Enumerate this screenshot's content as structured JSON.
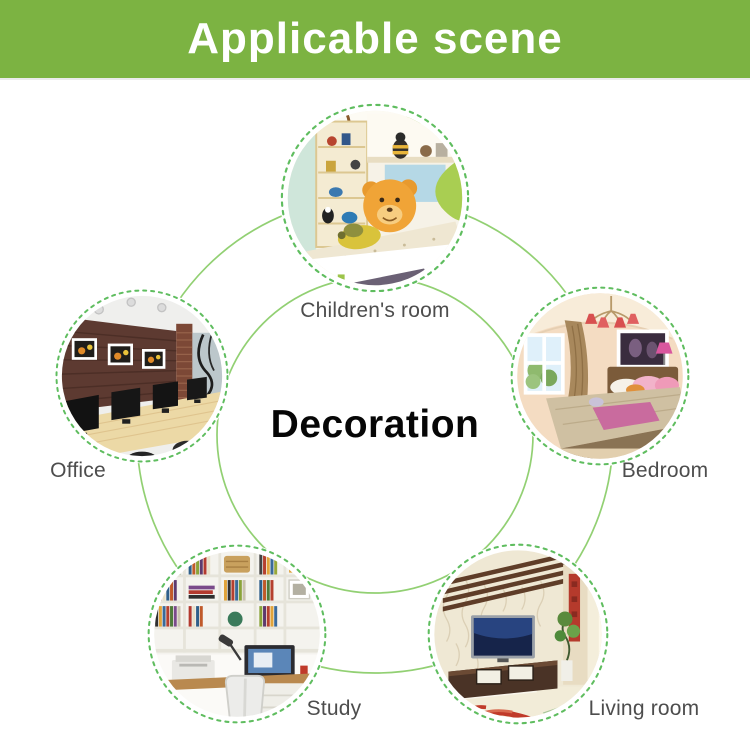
{
  "banner": {
    "title": "Applicable scene",
    "background_color": "#7cb342",
    "text_color": "#ffffff"
  },
  "diagram": {
    "center_title": "Decoration",
    "connector_color": "#92d073",
    "dashed_ring_color": "#5fbd5f",
    "scenes": [
      {
        "id": "children-room",
        "label": "Children's room",
        "position": "top"
      },
      {
        "id": "office",
        "label": "Office",
        "position": "left"
      },
      {
        "id": "bedroom",
        "label": "Bedroom",
        "position": "right"
      },
      {
        "id": "study",
        "label": "Study",
        "position": "bottom-left"
      },
      {
        "id": "living-room",
        "label": "Living room",
        "position": "bottom-right"
      }
    ]
  }
}
